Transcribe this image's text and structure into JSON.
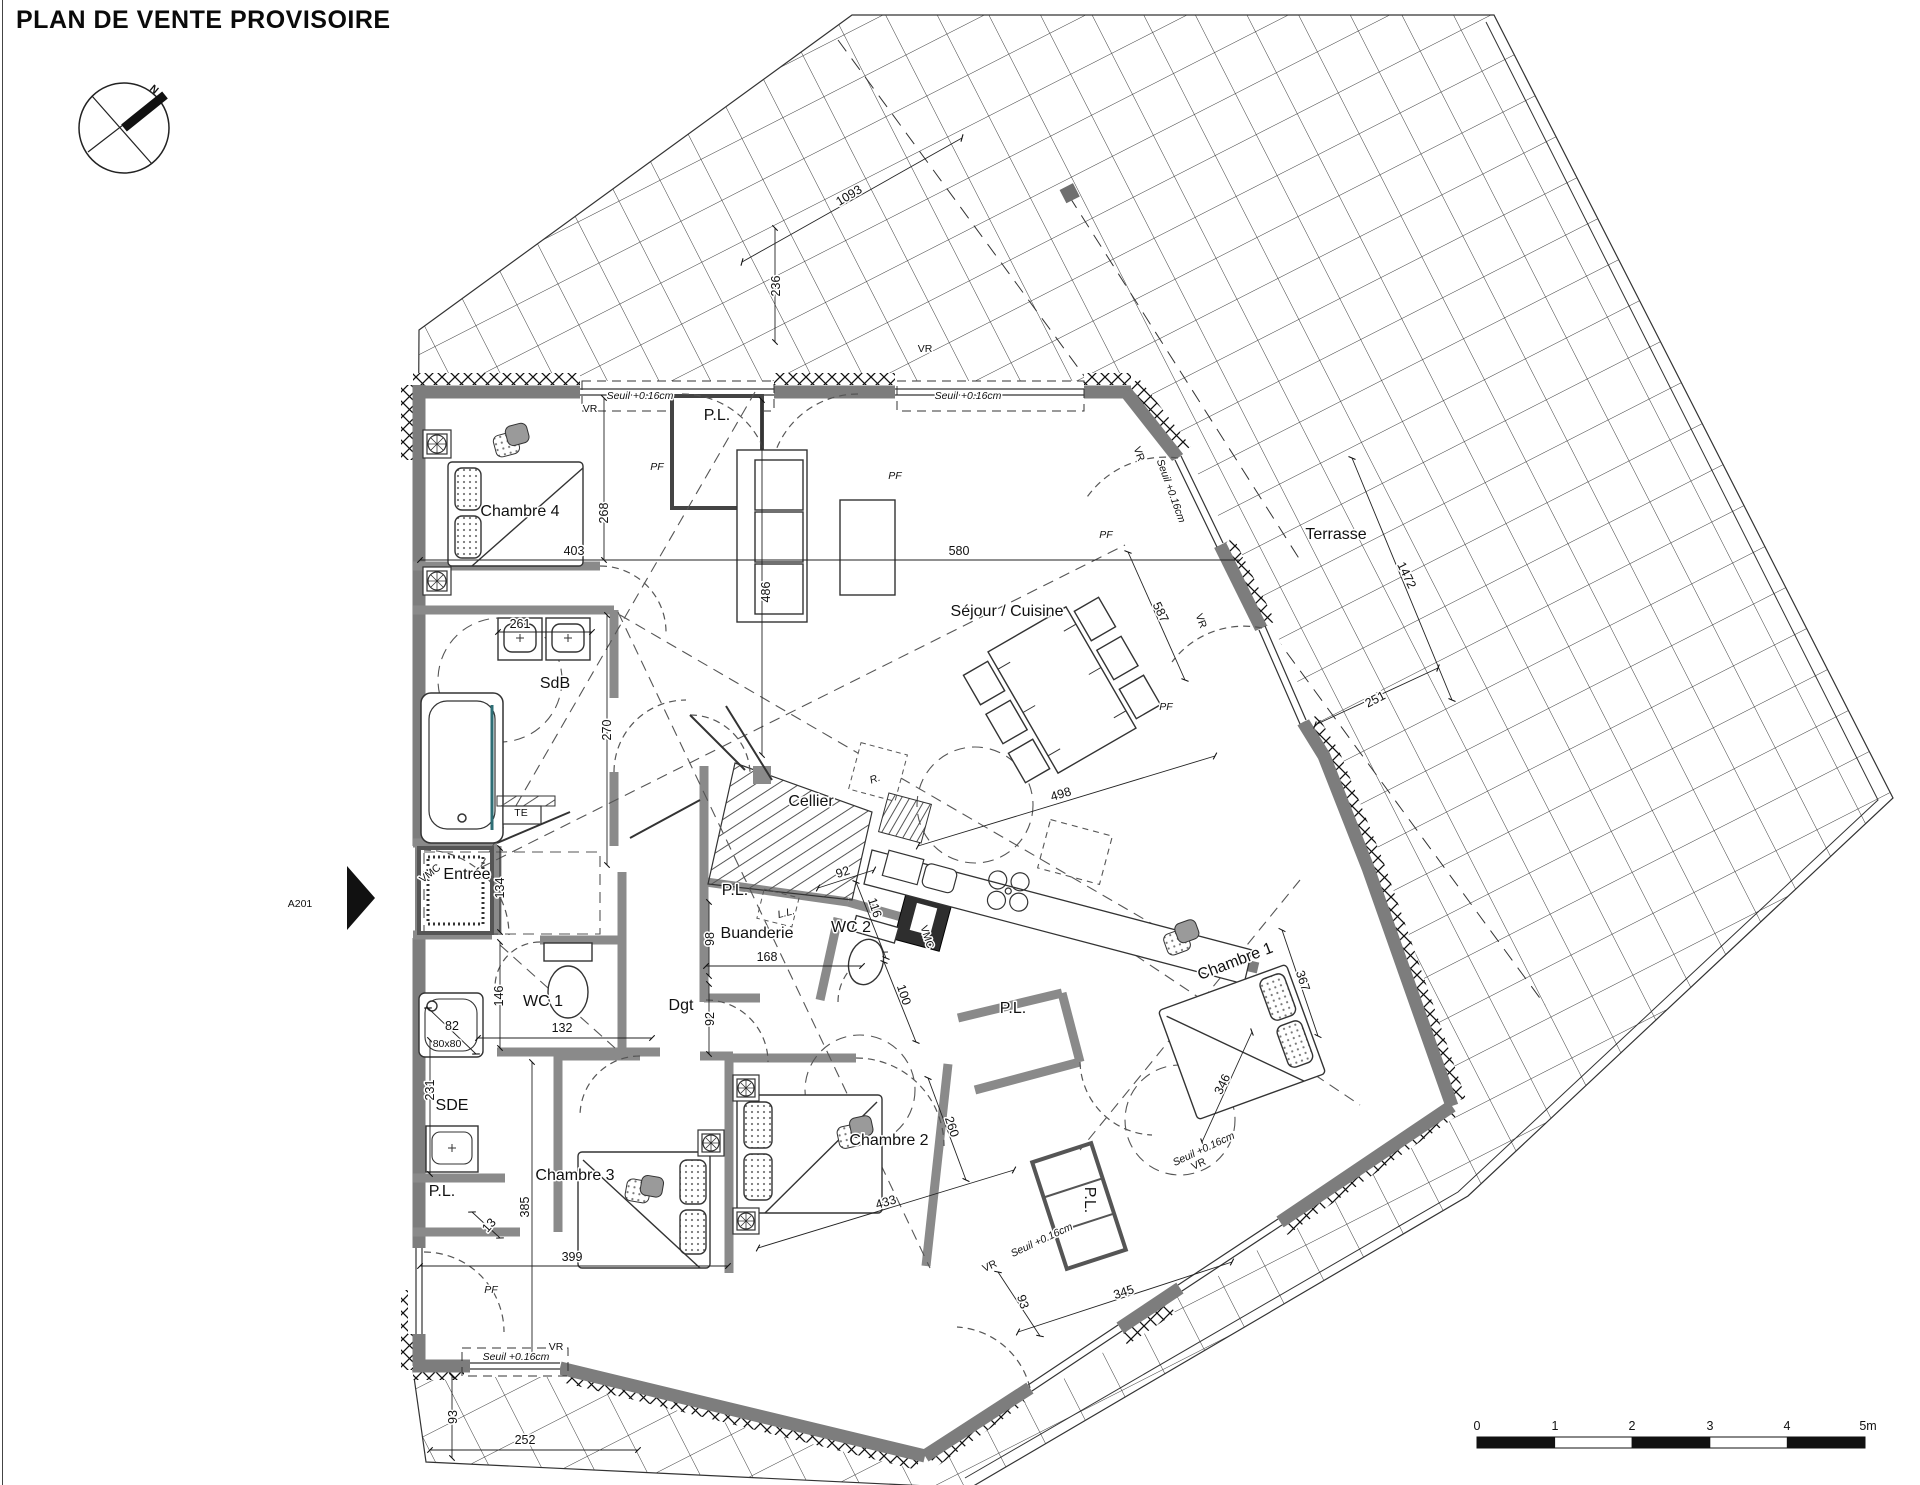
{
  "title": "PLAN DE VENTE PROVISOIRE",
  "rooms": [
    {
      "n": "room-chambre4",
      "t": "Chambre 4",
      "x": 520,
      "y": 516
    },
    {
      "n": "room-sdb",
      "t": "SdB",
      "x": 555,
      "y": 688
    },
    {
      "n": "room-entree",
      "t": "Entrée",
      "x": 467,
      "y": 879
    },
    {
      "n": "room-wc1",
      "t": "WC 1",
      "x": 543,
      "y": 1006
    },
    {
      "n": "room-sde",
      "t": "SDE",
      "x": 452,
      "y": 1110
    },
    {
      "n": "room-pl-sde",
      "t": "P.L.",
      "x": 442,
      "y": 1196,
      "s": 14
    },
    {
      "n": "room-chambre3",
      "t": "Chambre 3",
      "x": 575,
      "y": 1180
    },
    {
      "n": "room-chambre2",
      "t": "Chambre 2",
      "x": 889,
      "y": 1145
    },
    {
      "n": "room-dgt",
      "t": "Dgt",
      "x": 681,
      "y": 1010
    },
    {
      "n": "room-buanderie",
      "t": "Buanderie",
      "x": 757,
      "y": 938
    },
    {
      "n": "room-cellier",
      "t": "Cellier",
      "x": 811,
      "y": 806
    },
    {
      "n": "room-wc2",
      "t": "WC 2",
      "x": 851,
      "y": 932
    },
    {
      "n": "room-pl-top",
      "t": "P.L.",
      "x": 717,
      "y": 420,
      "s": 14
    },
    {
      "n": "room-pl-cellier",
      "t": "P.L.",
      "x": 735,
      "y": 895,
      "s": 13
    },
    {
      "n": "room-pl-ch1",
      "t": "P.L.",
      "x": 1013,
      "y": 1013,
      "s": 13
    },
    {
      "n": "room-pl-shaft",
      "t": "P.L.",
      "x": 1085,
      "y": 1200,
      "s": 11,
      "r": 90
    },
    {
      "n": "room-sejour",
      "t": "Séjour / Cuisine",
      "x": 1007,
      "y": 616
    },
    {
      "n": "room-chambre1",
      "t": "Chambre 1",
      "x": 1237,
      "y": 966,
      "r": -21
    },
    {
      "n": "room-terrasse",
      "t": "Terrasse",
      "x": 1336,
      "y": 539
    }
  ],
  "dimensions": [
    {
      "n": "dim-268",
      "t": "268",
      "x": 608,
      "y": 513,
      "r": -90
    },
    {
      "n": "dim-403",
      "t": "403",
      "x": 574,
      "y": 555
    },
    {
      "n": "dim-261",
      "t": "261",
      "x": 520,
      "y": 628
    },
    {
      "n": "dim-270",
      "t": "270",
      "x": 611,
      "y": 730,
      "r": -90
    },
    {
      "n": "dim-580",
      "t": "580",
      "x": 959,
      "y": 555
    },
    {
      "n": "dim-486",
      "t": "486",
      "x": 770,
      "y": 592,
      "r": -90
    },
    {
      "n": "dim-236",
      "t": "236",
      "x": 780,
      "y": 286,
      "r": -90
    },
    {
      "n": "dim-1093",
      "t": "1093",
      "x": 851,
      "y": 199,
      "r": -31
    },
    {
      "n": "dim-1472",
      "t": "1472",
      "x": 1403,
      "y": 577,
      "r": 64
    },
    {
      "n": "dim-251",
      "t": "251",
      "x": 1377,
      "y": 703,
      "r": -27
    },
    {
      "n": "dim-587",
      "t": "587",
      "x": 1157,
      "y": 614,
      "r": 64
    },
    {
      "n": "dim-498",
      "t": "498",
      "x": 1062,
      "y": 798,
      "r": -17
    },
    {
      "n": "dim-134",
      "t": "134",
      "x": 504,
      "y": 888,
      "r": -90
    },
    {
      "n": "dim-146",
      "t": "146",
      "x": 503,
      "y": 996,
      "r": -90
    },
    {
      "n": "dim-132",
      "t": "132",
      "x": 562,
      "y": 1032
    },
    {
      "n": "dim-82",
      "t": "82",
      "x": 452,
      "y": 1030
    },
    {
      "n": "dim-231",
      "t": "231",
      "x": 434,
      "y": 1090,
      "r": -90
    },
    {
      "n": "dim-385",
      "t": "385",
      "x": 529,
      "y": 1207,
      "r": -90
    },
    {
      "n": "dim-13",
      "t": "13",
      "x": 492,
      "y": 1228,
      "r": -48,
      "s": 11
    },
    {
      "n": "dim-399",
      "t": "399",
      "x": 572,
      "y": 1261
    },
    {
      "n": "dim-93-left",
      "t": "93",
      "x": 457,
      "y": 1417,
      "r": -90
    },
    {
      "n": "dim-252",
      "t": "252",
      "x": 525,
      "y": 1444
    },
    {
      "n": "dim-92-dgt",
      "t": "92",
      "x": 714,
      "y": 1019,
      "r": -90
    },
    {
      "n": "dim-98",
      "t": "98",
      "x": 714,
      "y": 939,
      "r": -90
    },
    {
      "n": "dim-168",
      "t": "168",
      "x": 767,
      "y": 961
    },
    {
      "n": "dim-92-wc2",
      "t": "92",
      "x": 844,
      "y": 876,
      "r": -18
    },
    {
      "n": "dim-116",
      "t": "116",
      "x": 871,
      "y": 909,
      "r": 72
    },
    {
      "n": "dim-100",
      "t": "100",
      "x": 900,
      "y": 996,
      "r": 72
    },
    {
      "n": "dim-260",
      "t": "260",
      "x": 948,
      "y": 1128,
      "r": 72
    },
    {
      "n": "dim-433",
      "t": "433",
      "x": 887,
      "y": 1206,
      "r": -17
    },
    {
      "n": "dim-346",
      "t": "346",
      "x": 1226,
      "y": 1086,
      "r": -64
    },
    {
      "n": "dim-367",
      "t": "367",
      "x": 1299,
      "y": 982,
      "r": 72
    },
    {
      "n": "dim-345",
      "t": "345",
      "x": 1125,
      "y": 1296,
      "r": -18
    },
    {
      "n": "dim-93-bottom",
      "t": "93",
      "x": 1019,
      "y": 1303,
      "r": 72
    }
  ],
  "annotations": [
    {
      "n": "seuil-top-left",
      "t": "Seuil +0.16cm",
      "x": 640,
      "y": 399,
      "i": 1
    },
    {
      "n": "seuil-top-mid",
      "t": "Seuil +0.16cm",
      "x": 968,
      "y": 399,
      "i": 1
    },
    {
      "n": "seuil-right",
      "t": "Seuil +0.16cm",
      "x": 1168,
      "y": 492,
      "r": 70,
      "i": 1
    },
    {
      "n": "seuil-bottom-left",
      "t": "Seuil +0.16cm",
      "x": 516,
      "y": 1360,
      "i": 1
    },
    {
      "n": "seuil-bottom-mid",
      "t": "Seuil +0.16cm",
      "x": 1043,
      "y": 1243,
      "r": -25,
      "i": 1
    },
    {
      "n": "seuil-chambre1",
      "t": "Seuil +0.16cm",
      "x": 1205,
      "y": 1152,
      "r": -25,
      "i": 1
    },
    {
      "n": "vr-top-left",
      "t": "VR",
      "x": 590,
      "y": 412,
      "s": 10
    },
    {
      "n": "vr-top-mid",
      "t": "VR",
      "x": 925,
      "y": 352,
      "s": 10
    },
    {
      "n": "vr-right-1",
      "t": "VR",
      "x": 1136,
      "y": 455,
      "r": 70,
      "s": 10
    },
    {
      "n": "vr-right-2",
      "t": "VR",
      "x": 1198,
      "y": 622,
      "r": 70,
      "s": 10
    },
    {
      "n": "vr-bottom-left",
      "t": "VR",
      "x": 556,
      "y": 1350,
      "s": 10
    },
    {
      "n": "vr-bottom-mid",
      "t": "VR",
      "x": 991,
      "y": 1269,
      "r": -25,
      "s": 10
    },
    {
      "n": "vr-chambre1",
      "t": "VR",
      "x": 1200,
      "y": 1167,
      "r": -25,
      "s": 10
    },
    {
      "n": "pf-chambre4",
      "t": "PF",
      "x": 657,
      "y": 470,
      "i": 1,
      "s": 12
    },
    {
      "n": "pf-sejour-left",
      "t": "PF",
      "x": 895,
      "y": 479,
      "i": 1,
      "s": 12
    },
    {
      "n": "pf-sejour-right",
      "t": "PF",
      "x": 1106,
      "y": 538,
      "i": 1,
      "s": 12
    },
    {
      "n": "pf-chambre1",
      "t": "PF",
      "x": 1166,
      "y": 710,
      "i": 1,
      "s": 12
    },
    {
      "n": "pf-chambre3",
      "t": "PF",
      "x": 491,
      "y": 1293,
      "i": 1,
      "s": 12
    },
    {
      "n": "te-label",
      "t": "TE",
      "x": 521,
      "y": 816,
      "s": 10
    },
    {
      "n": "vmc-sdb",
      "t": "VMC",
      "x": 432,
      "y": 876,
      "r": -38,
      "s": 10
    },
    {
      "n": "vmc-wc2",
      "t": "VMC",
      "x": 924,
      "y": 938,
      "r": 72,
      "s": 9,
      "w": 1
    },
    {
      "n": "ll-label",
      "t": "L.L.",
      "x": 787,
      "y": 916,
      "r": -14,
      "s": 9,
      "i": 1
    },
    {
      "n": "r-label",
      "t": "R.",
      "x": 876,
      "y": 782,
      "r": -20,
      "s": 10,
      "i": 1
    },
    {
      "n": "shower-size",
      "t": "80x80",
      "x": 447,
      "y": 1047,
      "s": 9
    },
    {
      "n": "north-letter",
      "t": "N",
      "x": 152,
      "y": 92,
      "r": 40,
      "s": 27,
      "b": 1
    },
    {
      "n": "unit-label",
      "t": "A201",
      "x": 300,
      "y": 907,
      "s": 32
    }
  ],
  "scalebar_labels": [
    {
      "n": "scale-0",
      "t": "0",
      "x": 1477,
      "y": 1430,
      "s": 13
    },
    {
      "n": "scale-1",
      "t": "1",
      "x": 1555,
      "y": 1430,
      "s": 13
    },
    {
      "n": "scale-2",
      "t": "2",
      "x": 1632,
      "y": 1430,
      "s": 13
    },
    {
      "n": "scale-3",
      "t": "3",
      "x": 1710,
      "y": 1430,
      "s": 13
    },
    {
      "n": "scale-4",
      "t": "4",
      "x": 1787,
      "y": 1430,
      "s": 13
    },
    {
      "n": "scale-5m",
      "t": "5m",
      "x": 1868,
      "y": 1430,
      "s": 13
    }
  ]
}
